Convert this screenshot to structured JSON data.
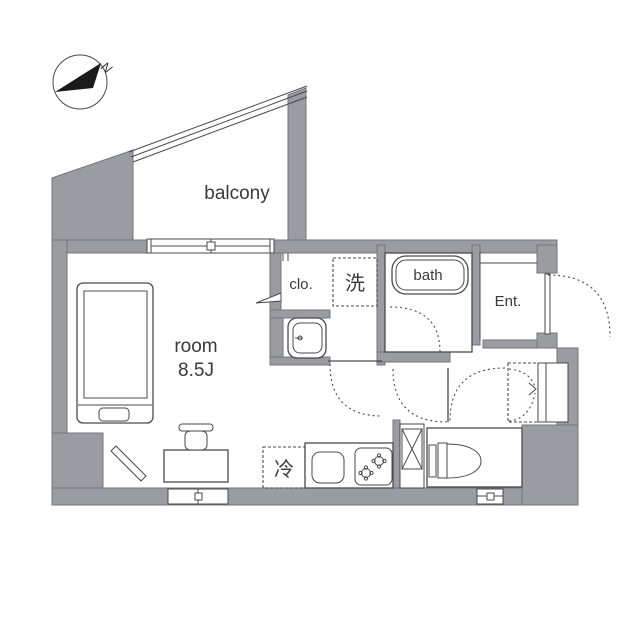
{
  "plan": {
    "compass_label": "N",
    "labels": {
      "balcony": "balcony",
      "room_name": "room",
      "room_size": "8.5J",
      "closet": "clo.",
      "washer": "洗",
      "bath": "bath",
      "entrance": "Ent.",
      "fridge": "冷"
    },
    "colors": {
      "wall": "#9b9ba2",
      "line": "#4a4a4f",
      "text": "#3a3a3a",
      "bg": "#ffffff"
    }
  }
}
